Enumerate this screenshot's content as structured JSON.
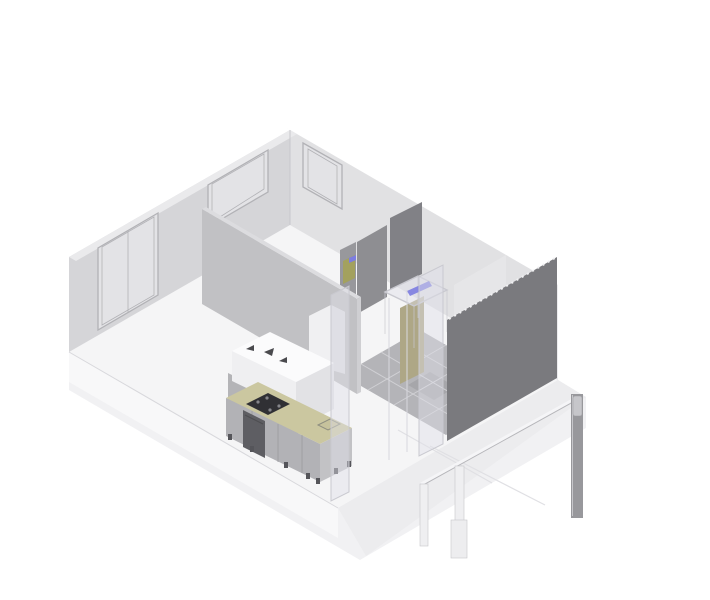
{
  "viewport": {
    "kind": "isometric-architectural-model",
    "background": "#ffffff"
  },
  "colors": {
    "background": "#ffffff",
    "slab_base": "#f1f1f3",
    "floor": "#f5f5f6",
    "slab_face_left": "#f8f8f9",
    "slab_face_right": "#ececee",
    "joint_line": "#e0e0e4",
    "edge_line": "#d8d8dc",
    "wall_back_left": "#d3d3d6",
    "wall_back_right": "#dfdfe2",
    "wall_cap": "#eaeaec",
    "wall_edge_strip": "#ececee",
    "window_glass": "#e3e3e6",
    "window_frame": "#b2b2b6",
    "hallway_wall": "#e6e6e8",
    "partition_main": "#c1c1c4",
    "partition_cap": "#dcdcdf",
    "partition_edge": "#cfcfd2",
    "wall_dark_1": "#8e8e92",
    "wall_dark_2": "#818186",
    "wall_dark_3": "#98989c",
    "feature_wall": "#7a7a7e",
    "feature_wall_dots": "#f0f0f2",
    "tile_floor": "#b4b4b8",
    "tile_joint": "#d0d0d4",
    "tile_dark": "#a6a6aa",
    "olive_panel": "#aea786",
    "olive_object": "#a3a15e",
    "blue_accent": "#7d7de0",
    "glass_fill": "rgba(224,224,232,0.45)",
    "glass_stroke": "#c9c9d0",
    "glass_mullion": "#d8d8de",
    "fridge_front": "#f0f0f2",
    "fridge_side": "#dfdfe2",
    "fridge_top": "#f8f8fa",
    "bar_top": "#fbfbfc",
    "bar_front": "#efeff1",
    "bar_side": "#e2e2e5",
    "bar_pedestal": "#b4b4b7",
    "counter_top": "#cbc7a0",
    "cooktop": "#303034",
    "burner": "#85858a",
    "sink_fill": "#c6c29c",
    "sink_rim": "#8e8e80",
    "cabinet_front": "#b2b2b6",
    "cabinet_seam": "#9b9b9f",
    "cabinet_side": "#c2c2c5",
    "appliance_dark": "#5e5e63",
    "toe_foot": "#55555a",
    "object_dark": "#4a4a4e",
    "rail": "#f5f5f7",
    "rail_shadow": "#b6b6ba",
    "post_white": "#efeff1",
    "post_outline": "#c6c6ca",
    "post_base": "#ededef",
    "post_dark": "#98989c",
    "post_cap": "#c6c6ca",
    "corner_edge": "#c8c8cc"
  }
}
